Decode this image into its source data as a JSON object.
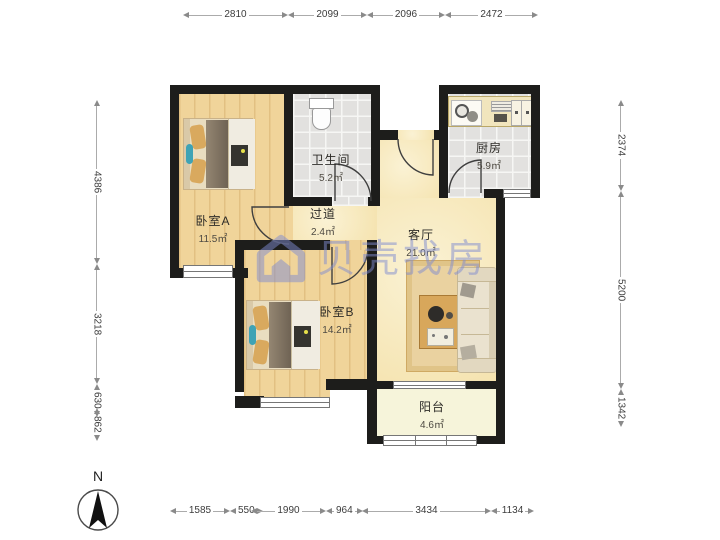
{
  "watermark": {
    "brand": "贝壳找房"
  },
  "compass": {
    "north_label": "N"
  },
  "rooms": {
    "bedroom_a": {
      "name": "卧室A",
      "area": "11.5㎡"
    },
    "bathroom": {
      "name": "卫生间",
      "area": "5.2㎡"
    },
    "hallway": {
      "name": "过道",
      "area": "2.4㎡"
    },
    "living_room": {
      "name": "客厅",
      "area": "21.0㎡"
    },
    "kitchen": {
      "name": "厨房",
      "area": "5.9㎡"
    },
    "bedroom_b": {
      "name": "卧室B",
      "area": "14.2㎡"
    },
    "balcony": {
      "name": "阳台",
      "area": "4.6㎡"
    }
  },
  "dimensions_mm": {
    "top": [
      "2810",
      "2099",
      "2096",
      "2472"
    ],
    "left": [
      "4386",
      "3218",
      "630",
      "862"
    ],
    "right": [
      "2374",
      "5200",
      "1342"
    ],
    "bottom": [
      "1585",
      "550",
      "1990",
      "964",
      "3434",
      "1134"
    ]
  },
  "colors": {
    "wall": "#1d1d1b",
    "wood_floor": "#f0d49a",
    "tile_floor": "#e2e1df",
    "living_floor": "#f8ebbd",
    "balcony_floor": "#f6f4da",
    "watermark": "#7f8cd1"
  }
}
